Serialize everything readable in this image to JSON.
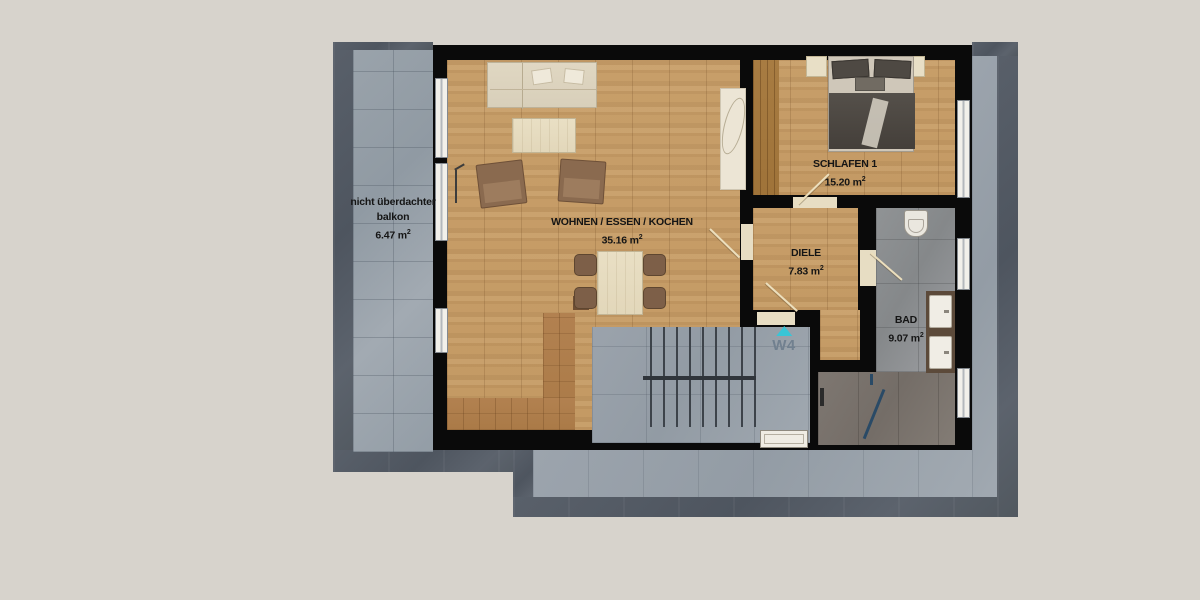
{
  "rooms": {
    "balcony": {
      "line1": "nicht überdachter",
      "line2": "balkon",
      "area": "6.47 m",
      "exp": "2"
    },
    "living": {
      "name": "WOHNEN / ESSEN / KOCHEN",
      "area": "35.16 m",
      "exp": "2"
    },
    "bedroom": {
      "name": "SCHLAFEN 1",
      "area": "15.20 m",
      "exp": "2"
    },
    "hall": {
      "name": "DIELE",
      "area": "7.83 m",
      "exp": "2"
    },
    "bath": {
      "name": "BAD",
      "area": "9.07 m",
      "exp": "2"
    }
  },
  "unit": {
    "label": "W4"
  },
  "colors": {
    "background": "#d7d3cc",
    "outer_band": "#545b64",
    "walkway": "#9aa2ab",
    "balcony_tile": "#97a0a7",
    "wall": "#0a0a0a",
    "wood_floor": "#c79e69",
    "kitchen_counter": "#b08049",
    "bath_tile": "#8d9092",
    "shower_floor": "#7c756e",
    "marker_triangle": "#39c5d6",
    "marker_text": "#71808f",
    "label_text": "#151515"
  }
}
